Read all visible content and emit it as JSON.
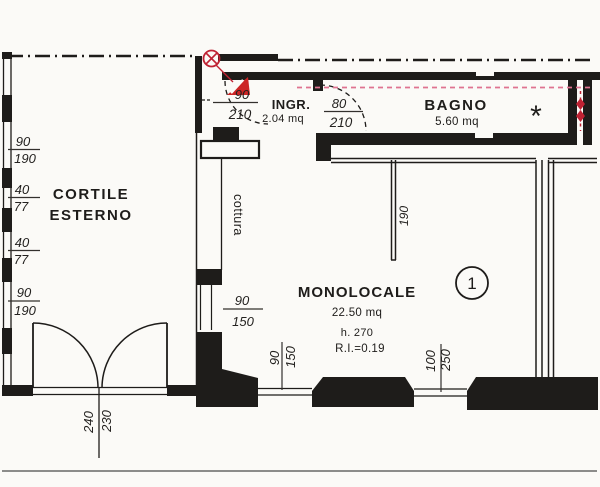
{
  "palette": {
    "paper": "#fbfaf7",
    "ink": "#1e1c1a",
    "red": "#bf2233",
    "pink": "#df7390"
  },
  "rooms": {
    "cortile": {
      "line1": "CORTILE",
      "line2": "ESTERNO"
    },
    "ingresso": {
      "name": "INGR.",
      "area": "2.04 mq"
    },
    "bagno": {
      "name": "BAGNO",
      "area": "5.60 mq",
      "star": "*"
    },
    "monolocale": {
      "name": "MONOLOCALE",
      "area": "22.50 mq",
      "height": "h. 270",
      "ratio": "R.I.=0.19",
      "unit": "1"
    },
    "cottura": "cottura"
  },
  "dims": {
    "left_windows": [
      {
        "w": "90",
        "h": "190"
      },
      {
        "w": "40",
        "h": "77"
      },
      {
        "w": "40",
        "h": "77"
      },
      {
        "w": "90",
        "h": "190"
      }
    ],
    "entry_door": {
      "w": "90",
      "h": "210"
    },
    "bagno_door": {
      "w": "80",
      "h": "210"
    },
    "partition_length": "190",
    "west_window": {
      "w": "90",
      "h": "150"
    },
    "south_window_left": {
      "w": "90",
      "h": "150"
    },
    "south_window_right": {
      "w": "100",
      "h": "250"
    },
    "courtyard_door": {
      "w": "240",
      "h": "230"
    }
  }
}
